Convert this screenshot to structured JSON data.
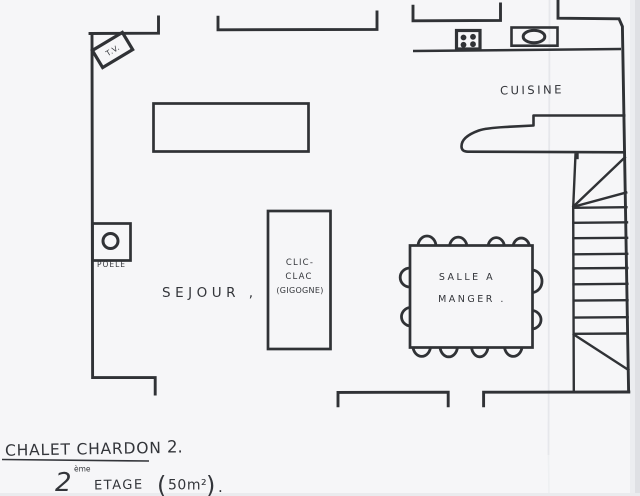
{
  "plan": {
    "rooms": {
      "sejour": {
        "label": "SEJOUR ,"
      },
      "cuisine": {
        "label": "CUISINE"
      },
      "salle_a_manger": {
        "line1": "SALLE A",
        "line2": "MANGER ."
      }
    },
    "furniture": {
      "tv": {
        "label": "T.V."
      },
      "poele": {
        "label": "POELE"
      },
      "clic_clac": {
        "line1": "CLIC-",
        "line2": "CLAC",
        "line3": "(GIGOGNE)"
      },
      "dining_table": {
        "chair_count": 12
      },
      "stove": {
        "burner_count": 4
      }
    },
    "stairs": {
      "tread_count": 9
    }
  },
  "title_block": {
    "line1": {
      "name": "CHALET CHARDON",
      "separator": ".",
      "number": "2."
    },
    "line2": {
      "digit": "2",
      "ordinal": "ème",
      "word": "ETAGE",
      "paren_open": "(",
      "area": "50m²",
      "paren_close": ")",
      "period": "."
    }
  },
  "colors": {
    "ink": "#303236",
    "paper": "#f6f6f8",
    "crease": "#e6e7eb",
    "edge_shade": "#dfe0e4"
  }
}
